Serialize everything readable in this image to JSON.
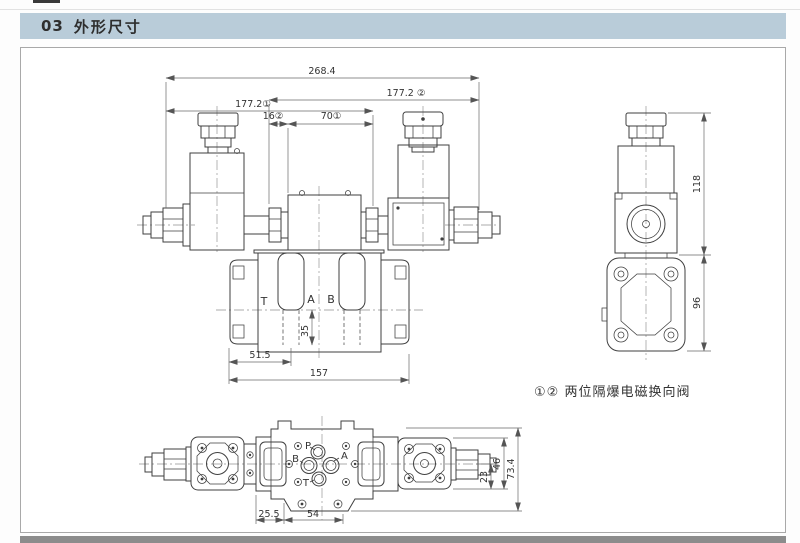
{
  "header": {
    "number": "03",
    "title": "外形尺寸"
  },
  "note": {
    "text": "①② 两位隔爆电磁换向阀"
  },
  "front_view": {
    "dim_overall": "268.4",
    "dim_177_2": "177.2 ②",
    "dim_177_1": "177.2①",
    "dim_16": "16②",
    "dim_70": "70①",
    "dim_35": "35",
    "dim_51_5": "51.5",
    "dim_157": "157",
    "port_t": "T",
    "port_a": "A",
    "port_b": "B"
  },
  "side_view": {
    "dim_118": "118",
    "dim_96": "96"
  },
  "top_view": {
    "port_p": "P",
    "port_a": "A",
    "port_b": "B",
    "port_t": "T",
    "dim_25_5": "25.5",
    "dim_54": "54",
    "dim_23": "23",
    "dim_46": "46",
    "dim_73_4": "73.4"
  },
  "colors": {
    "header_bg": "#b9ccd9",
    "drawing_line": "#3f3f3f",
    "dimension_line": "#6a6a6a",
    "footer_bar": "#8c8c8c"
  }
}
